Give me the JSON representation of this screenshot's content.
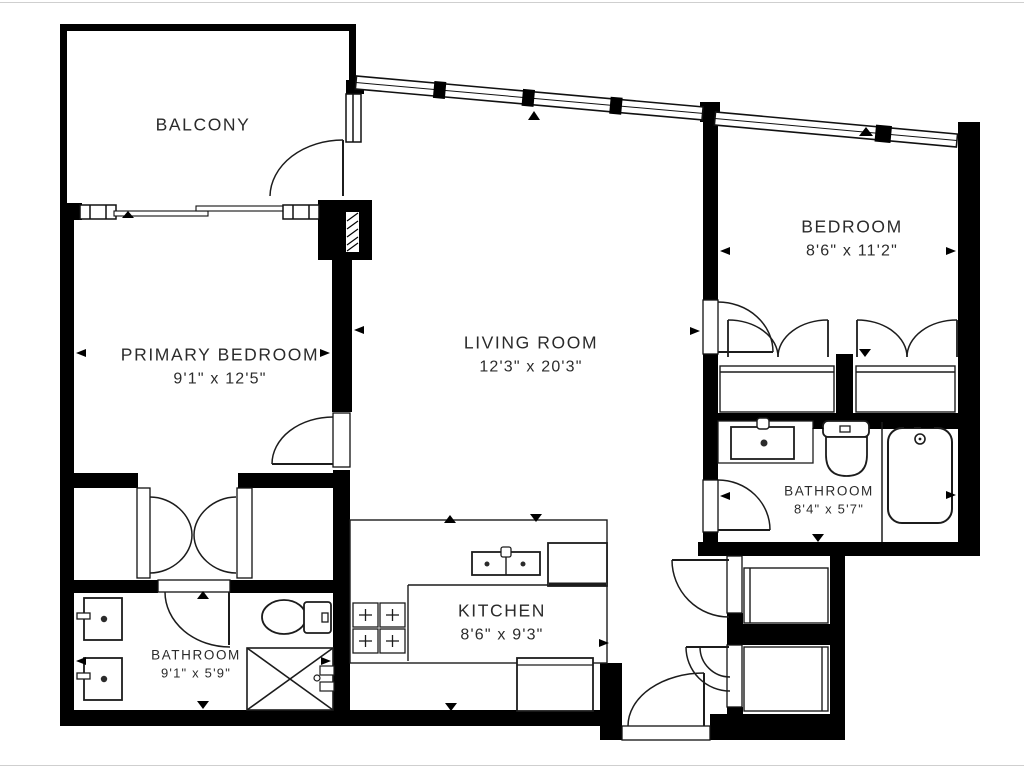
{
  "plan": {
    "type": "apartment-floor-plan",
    "colors": {
      "wall": "#000000",
      "line": "#1c1c1c",
      "text": "#2b2b2b",
      "background": "#ffffff"
    },
    "rooms": [
      {
        "label": "BALCONY",
        "dims": ""
      },
      {
        "label": "PRIMARY BEDROOM",
        "dims": "9'1\" x 12'5\""
      },
      {
        "label": "LIVING ROOM",
        "dims": "12'3\" x 20'3\""
      },
      {
        "label": "BEDROOM",
        "dims": "8'6\" x 11'2\""
      },
      {
        "label": "KITCHEN",
        "dims": "8'6\" x 9'3\""
      },
      {
        "label": "BATHROOM",
        "dims": "9'1\" x 5'9\""
      },
      {
        "label": "BATHROOM",
        "dims": "8'4\" x 5'7\""
      }
    ]
  }
}
